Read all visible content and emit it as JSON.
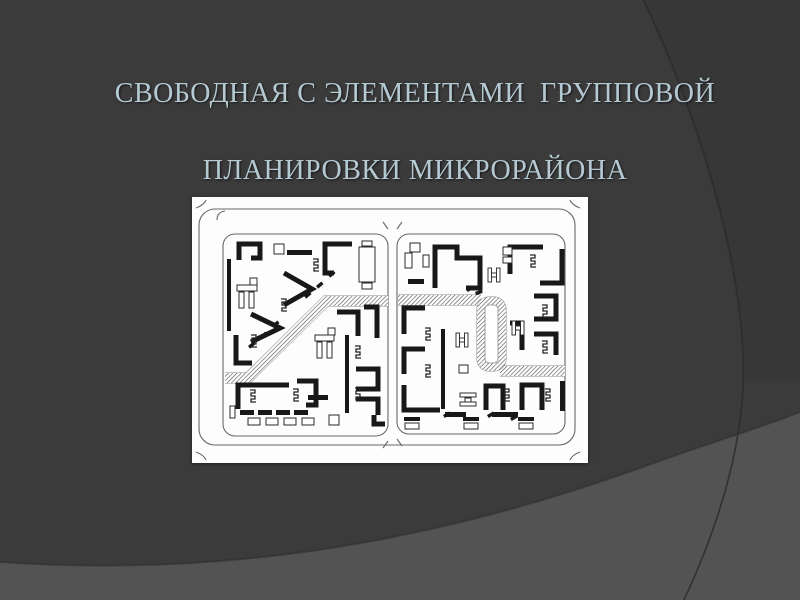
{
  "slide": {
    "title_line1": "СВОБОДНАЯ С ЭЛЕМЕНТАМИ  ГРУППОВОЙ",
    "title_line2": "ПЛАНИРОВКИ МИКРОРАЙОНА",
    "colors": {
      "background": "#3b3b3b",
      "background_dark_corner": "#363636",
      "background_light_sweep": "#535353",
      "curve_line": "#2b2b2b",
      "title_text": "#b5c9d3",
      "panel_bg": "#fdfdfd",
      "street_line": "#686868",
      "building_ink": "#181818",
      "symbol_ink": "#242424",
      "band_edge": "#8a8a8a",
      "hatch_line": "#4f4f4f"
    },
    "background_shapes": {
      "dark_corner_fill": "M642,0 C702,125 744,280 743,380 L800,380 L800,0 Z",
      "light_sweep_fill": "M0,562 C230,578 440,540 640,468 C700,446 760,428 800,412 L800,600 L0,600 Z",
      "sweep_edge": "M0,562 C230,578 440,540 640,468 C700,446 760,428 800,412",
      "arc_line": "M642,-4 C705,130 748,280 743,390 C738,470 710,545 682,604"
    },
    "figure": {
      "viewbox": "0 0 396 266",
      "streets": {
        "outer": {
          "x": 7,
          "y": 12,
          "w": 376,
          "h": 236,
          "rx": 16
        },
        "blocks": [
          {
            "x": 31,
            "y": 37,
            "w": 165,
            "h": 202,
            "rx": 12
          },
          {
            "x": 205,
            "y": 37,
            "w": 168,
            "h": 200,
            "rx": 12
          }
        ],
        "flares": [
          "M14,3 Q12,8 4,11",
          "M378,3 Q380,8 388,11",
          "M14,263 Q12,258 4,255",
          "M378,263 Q380,258 388,255",
          "M25,23 Q25,15 33,14",
          "M196,32 L191,25",
          "M205,32 L210,25",
          "M196,244 L191,251",
          "M205,242 L210,249"
        ]
      },
      "bands": {
        "width": 10,
        "paths": [
          "M33,181 H56 L134,104 H196",
          "M206,103 H289",
          "M308,174 H373"
        ],
        "loop": {
          "x": 289,
          "y": 104,
          "w": 21,
          "h": 66,
          "rx": 8
        },
        "loop_inner": {
          "x": 293,
          "y": 108,
          "w": 13,
          "h": 58,
          "rx": 4
        }
      },
      "strokes": [
        "M47,63 V47 H68 V61 H59",
        "M160,47 H133 V76 H142",
        "M92,76 L120,92 L92,108",
        "M59,117 L88,131 L59,145",
        "M44,138 V166 H60",
        "M105,184 H124 V208 H114",
        "M46,212 V188 H97",
        "M164,172 H186 V192 H164",
        "M164,202 H186 V218",
        "M182,218 V227 H193",
        "M145,115 H166 V139",
        "M172,110 H185 V141",
        "M243,91 V50 H265 V61 H288 V91 H274",
        "M318,77 V50 H351",
        "M348,86 H370 V52",
        "M342,99 H364 V122 H342",
        "M342,137 H364 V158",
        "M318,126 H330 V153",
        "M212,137 V111 H233",
        "M212,177 V152 H233",
        "M212,188 V213 H248",
        "M294,213 V189 H311 V213",
        "M330,213 V188 H350 V213"
      ],
      "bars": [
        [
          95,
          53,
          25,
          5
        ],
        [
          35,
          62,
          4,
          72
        ],
        [
          153,
          138,
          4,
          78
        ],
        [
          116,
          198,
          20,
          5
        ],
        [
          48,
          213,
          14,
          5
        ],
        [
          66,
          213,
          14,
          5
        ],
        [
          84,
          213,
          14,
          5
        ],
        [
          102,
          213,
          14,
          5
        ],
        [
          169,
          57,
          12,
          4
        ],
        [
          169,
          65,
          12,
          4
        ],
        [
          169,
          73,
          12,
          4
        ],
        [
          216,
          82,
          16,
          5
        ],
        [
          249,
          132,
          4,
          80
        ],
        [
          368,
          184,
          5,
          30
        ],
        [
          253,
          215,
          21,
          5
        ],
        [
          300,
          215,
          26,
          5
        ],
        [
          212,
          220,
          16,
          4
        ],
        [
          271,
          220,
          16,
          4
        ],
        [
          326,
          220,
          16,
          4
        ]
      ],
      "outlines": [
        [
          82,
          47,
          10,
          10
        ],
        [
          167,
          50,
          16,
          35
        ],
        [
          170,
          44,
          10,
          5
        ],
        [
          170,
          86,
          10,
          6
        ],
        [
          45,
          88,
          20,
          6
        ],
        [
          58,
          81,
          7,
          7
        ],
        [
          47,
          95,
          5,
          16
        ],
        [
          57,
          95,
          5,
          16
        ],
        [
          123,
          138,
          19,
          6
        ],
        [
          136,
          131,
          7,
          7
        ],
        [
          125,
          145,
          5,
          16
        ],
        [
          135,
          145,
          5,
          16
        ],
        [
          38,
          209,
          5,
          12
        ],
        [
          56,
          221,
          12,
          7
        ],
        [
          74,
          221,
          12,
          7
        ],
        [
          92,
          221,
          12,
          7
        ],
        [
          110,
          221,
          12,
          7
        ],
        [
          137,
          218,
          10,
          10
        ],
        [
          213,
          56,
          7,
          15
        ],
        [
          218,
          46,
          10,
          9
        ],
        [
          231,
          58,
          6,
          12
        ],
        [
          311,
          50,
          9,
          8
        ],
        [
          311,
          60,
          9,
          6
        ],
        [
          267,
          168,
          9,
          8
        ],
        [
          268,
          196,
          16,
          4
        ],
        [
          273,
          201,
          6,
          4
        ],
        [
          268,
          205,
          16,
          4
        ],
        [
          213,
          226,
          14,
          6
        ],
        [
          272,
          226,
          14,
          6
        ],
        [
          327,
          226,
          14,
          6
        ]
      ],
      "zigzags": [
        [
          120,
          62
        ],
        [
          88,
          102
        ],
        [
          58,
          138
        ],
        [
          57,
          193
        ],
        [
          100,
          192
        ],
        [
          162,
          149
        ],
        [
          162,
          191
        ],
        [
          337,
          58
        ],
        [
          349,
          108
        ],
        [
          349,
          144
        ],
        [
          232,
          131
        ],
        [
          232,
          168
        ],
        [
          311,
          192
        ],
        [
          352,
          192
        ]
      ],
      "hsyms": [
        [
          296,
          71
        ],
        [
          320,
          124
        ],
        [
          264,
          136
        ]
      ],
      "ticks": [
        [
          136,
          78,
          -40
        ],
        [
          124,
          89,
          -40
        ],
        [
          112,
          99,
          -40
        ],
        [
          80,
          128,
          -40
        ],
        [
          68,
          139,
          -40
        ],
        [
          56,
          149,
          -40
        ],
        [
          274,
          92,
          -30
        ],
        [
          283,
          95,
          -20
        ],
        [
          251,
          218,
          -30
        ],
        [
          295,
          218,
          -30
        ],
        [
          318,
          221,
          -30
        ]
      ]
    }
  }
}
